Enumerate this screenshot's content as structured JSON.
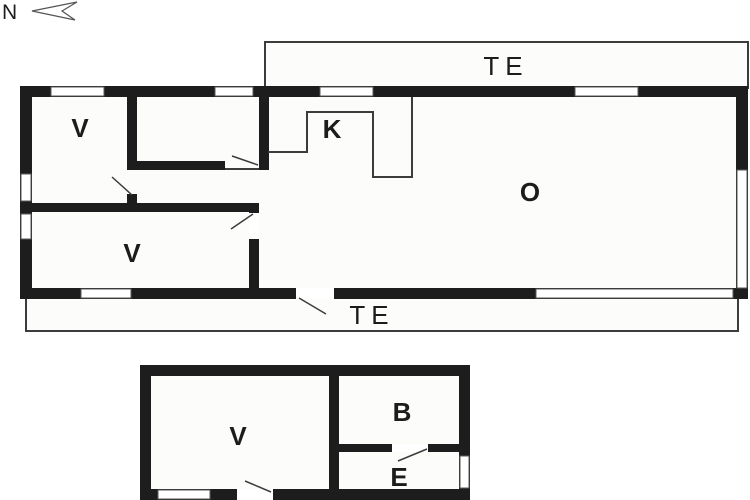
{
  "compass": {
    "label": "N",
    "direction": "north-pointing-left"
  },
  "colors": {
    "wall": "#1d1d1d",
    "thin_line": "#3c3c3c",
    "room_fill": "#fcfcfa",
    "background": "#ffffff",
    "label_text": "#1c1c1c"
  },
  "main_building": {
    "terrace_top": {
      "label": "TE"
    },
    "terrace_bottom": {
      "label": "TE"
    },
    "rooms": {
      "bedroom_top_left": {
        "label": "V"
      },
      "bedroom_bottom_left": {
        "label": "V"
      },
      "kitchen": {
        "label": "K"
      },
      "living_room": {
        "label": "O"
      }
    }
  },
  "annex": {
    "rooms": {
      "room_v": {
        "label": "V"
      },
      "bathroom": {
        "label": "B"
      },
      "entry": {
        "label": "E"
      }
    }
  }
}
